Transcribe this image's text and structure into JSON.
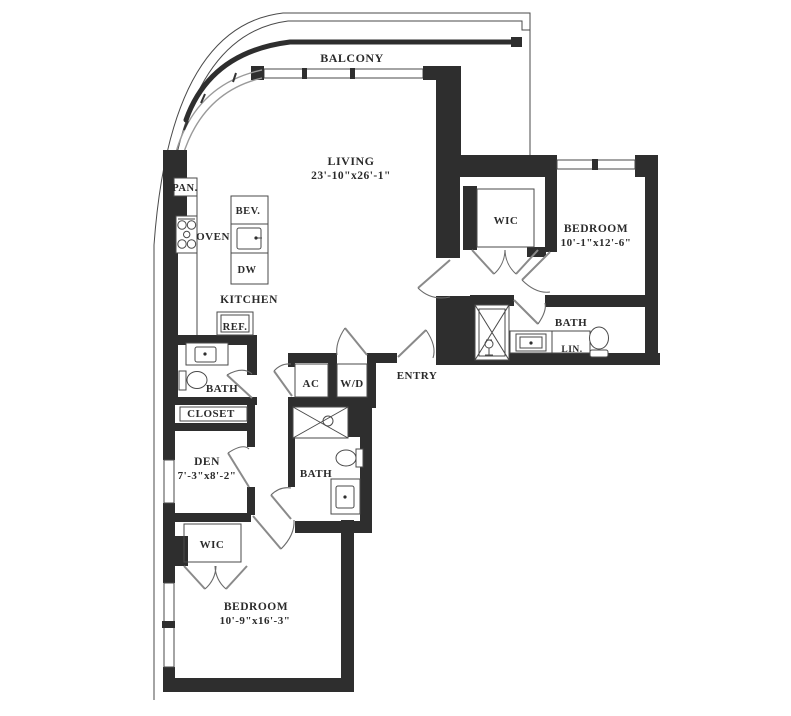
{
  "colors": {
    "wall": "#2e2e2e",
    "line": "#4a4a4a",
    "glass": "#9a9a9a",
    "text": "#2b2b2b",
    "background": "#ffffff"
  },
  "rooms": {
    "balcony": {
      "label": "BALCONY"
    },
    "living": {
      "label": "LIVING",
      "dims": "23'-10\"x26'-1\""
    },
    "kitchen": {
      "label": "KITCHEN"
    },
    "entry": {
      "label": "ENTRY"
    },
    "den": {
      "label": "DEN",
      "dims": "7'-3\"x8'-2\""
    },
    "closet": {
      "label": "CLOSET"
    },
    "bedroom_right": {
      "label": "BEDROOM",
      "dims": "10'-1\"x12'-6\""
    },
    "bedroom_bottom": {
      "label": "BEDROOM",
      "dims": "10'-9\"x16'-3\""
    },
    "wic_right": {
      "label": "WIC"
    },
    "wic_bottom": {
      "label": "WIC"
    },
    "bath_left": {
      "label": "BATH"
    },
    "bath_center": {
      "label": "BATH"
    },
    "bath_right": {
      "label": "BATH"
    }
  },
  "fixtures": {
    "pantry": "PAN.",
    "oven": "OVEN",
    "beverage": "BEV.",
    "dishwasher": "DW",
    "refrigerator": "REF.",
    "ac": "AC",
    "washer_dryer": "W/D",
    "linen": "LIN."
  }
}
